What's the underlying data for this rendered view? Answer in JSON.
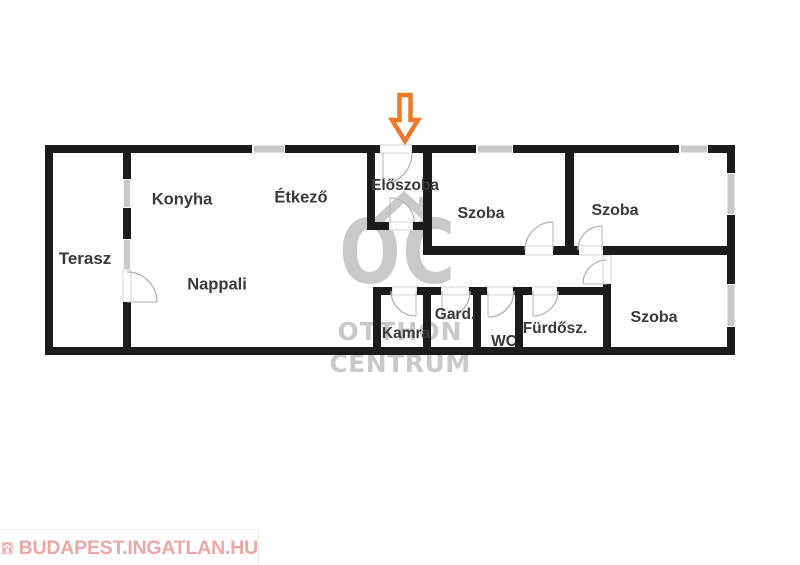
{
  "floorplan": {
    "rooms": {
      "terasz": {
        "label": "Terasz"
      },
      "konyha": {
        "label": "Konyha"
      },
      "etkezo": {
        "label": "Étkező"
      },
      "eloszoba": {
        "label": "Előszoba"
      },
      "szoba_top_middle": {
        "label": "Szoba"
      },
      "szoba_top_right": {
        "label": "Szoba"
      },
      "nappali": {
        "label": "Nappali"
      },
      "kamra": {
        "label": "Kamra"
      },
      "gard": {
        "label": "Gard."
      },
      "wc": {
        "label": "WC"
      },
      "furdoszoba": {
        "label": "Fürdősz."
      },
      "szoba_bottom_right": {
        "label": "Szoba"
      }
    },
    "entrance_arrow_icon": "down-arrow"
  },
  "watermark": {
    "oc": "OC",
    "line1": "OTTHON",
    "line2": "CENTRUM",
    "roof_icon": "roof-chimney"
  },
  "footer_logo": {
    "text": "BUDAPEST.INGATLAN.HU",
    "icon": "house-icon"
  },
  "colors": {
    "wall": "#1b1b1b",
    "window": "#c9c9c9",
    "door_arc": "#b5b5b5",
    "accent_orange": "#f0782a",
    "watermark_gray": "#c9c9c9",
    "logo_pink": "#eca6a3",
    "label_text": "#3a3a3a"
  }
}
